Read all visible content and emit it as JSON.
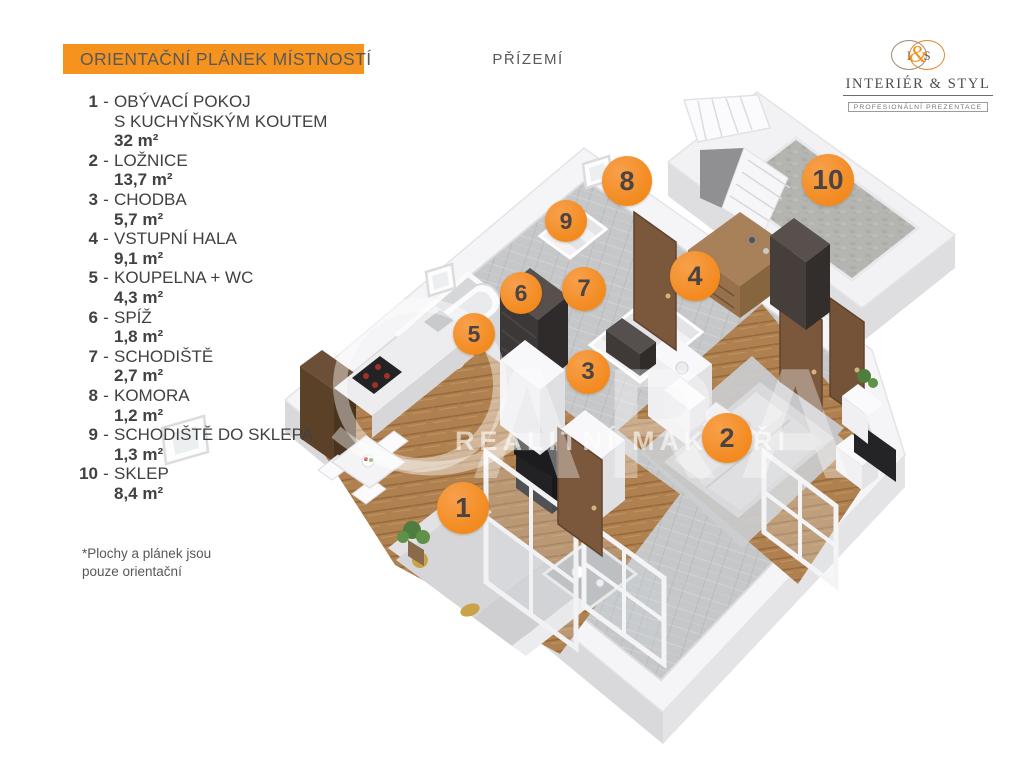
{
  "header": {
    "title": "ORIENTAČNÍ PLÁNEK MÍSTNOSTÍ",
    "floor_label": "PŘÍZEMÍ"
  },
  "logo": {
    "initial_left": "I",
    "ampersand": "&",
    "initial_right": "S",
    "name": "INTERIÉR & STYL",
    "tagline": "PROFESIONÁLNÍ PREZENTACE"
  },
  "legend": {
    "dash": "-",
    "items": [
      {
        "num": "1",
        "name": "OBÝVACÍ POKOJ",
        "name_line2": "S KUCHYŇSKÝM KOUTEM",
        "area": "32 m²"
      },
      {
        "num": "2",
        "name": "LOŽNICE",
        "area": "13,7 m²"
      },
      {
        "num": "3",
        "name": "CHODBA",
        "area": "5,7 m²"
      },
      {
        "num": "4",
        "name": "VSTUPNÍ HALA",
        "area": "9,1 m²"
      },
      {
        "num": "5",
        "name": "KOUPELNA + WC",
        "area": "4,3 m²"
      },
      {
        "num": "6",
        "name": "SPÍŽ",
        "area": "1,8 m²"
      },
      {
        "num": "7",
        "name": "SCHODIŠTĚ",
        "area": "2,7 m²"
      },
      {
        "num": "8",
        "name": "KOMORA",
        "area": "1,2 m²"
      },
      {
        "num": "9",
        "name": "SCHODIŠTĚ DO SKLEPA",
        "area": "1,3 m²"
      },
      {
        "num": "10",
        "name": "SKLEP",
        "area": "8,4 m²"
      }
    ]
  },
  "footnote": {
    "line1": "*Plochy  a plánek jsou",
    "line2": "pouze orientační"
  },
  "plan": {
    "watermark_text": "REALITNÍ MAKLÉŘI",
    "watermark_letters": "ARA",
    "markers": [
      {
        "label": "1",
        "x": 463,
        "y": 508,
        "s": 52
      },
      {
        "label": "2",
        "x": 727,
        "y": 438,
        "s": 50
      },
      {
        "label": "3",
        "x": 588,
        "y": 372,
        "s": 44
      },
      {
        "label": "4",
        "x": 695,
        "y": 276,
        "s": 50
      },
      {
        "label": "5",
        "x": 474,
        "y": 334,
        "s": 42
      },
      {
        "label": "6",
        "x": 521,
        "y": 293,
        "s": 42
      },
      {
        "label": "7",
        "x": 584,
        "y": 289,
        "s": 44
      },
      {
        "label": "8",
        "x": 627,
        "y": 181,
        "s": 50
      },
      {
        "label": "9",
        "x": 566,
        "y": 221,
        "s": 42
      },
      {
        "label": "10",
        "x": 828,
        "y": 180,
        "s": 52
      }
    ]
  },
  "colors": {
    "accent": "#F6921E",
    "banner_text": "#58595B",
    "legend_text": "#414042",
    "marker_number": "#4C4442"
  }
}
